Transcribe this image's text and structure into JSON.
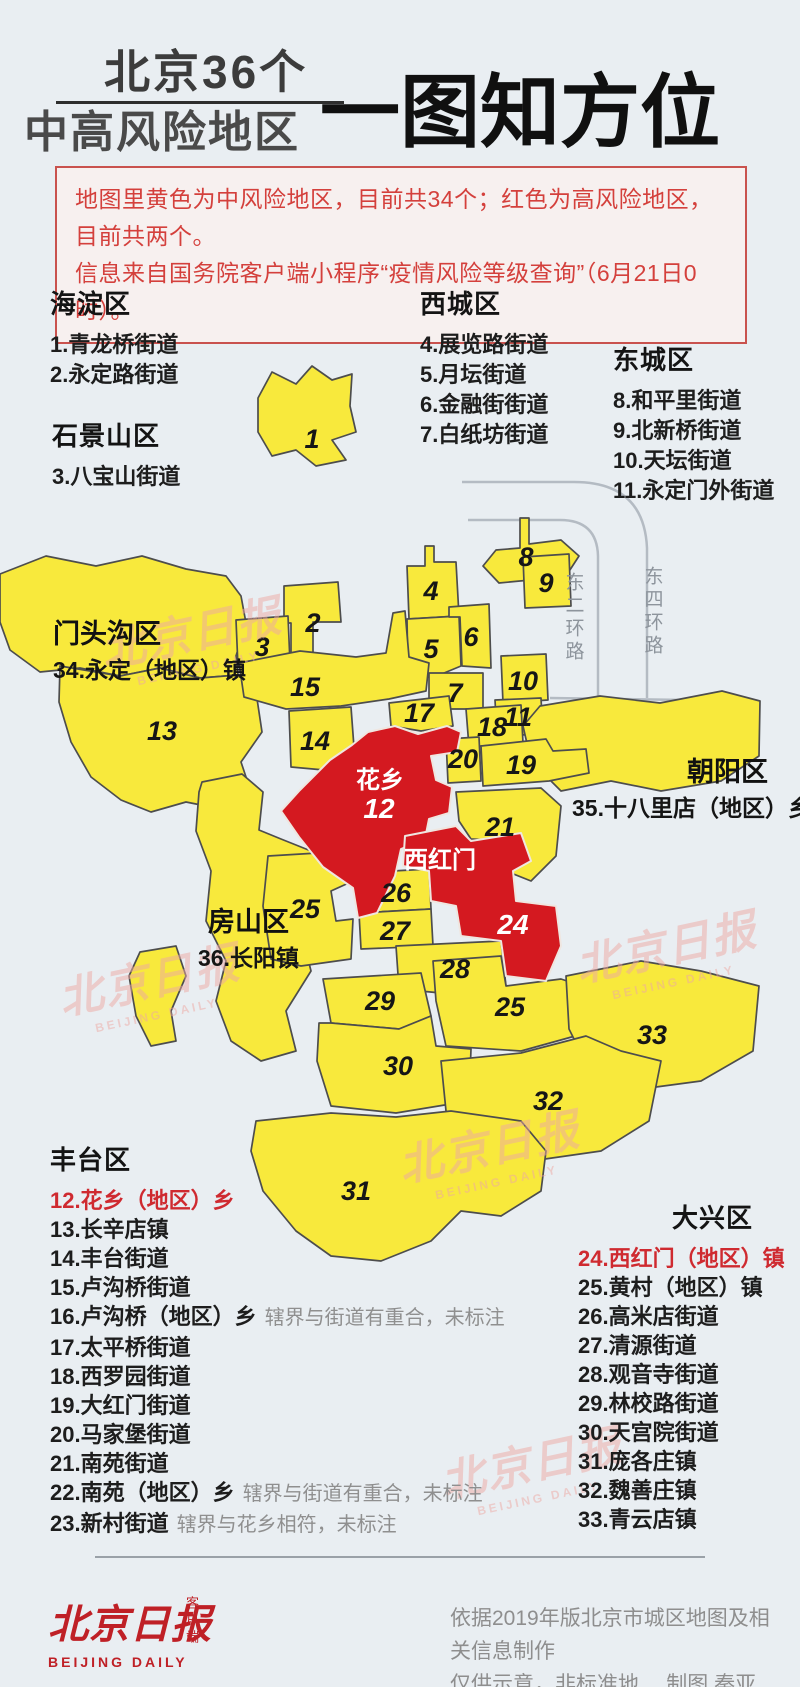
{
  "header": {
    "title_line1": "北京36个",
    "title_line2": "中高风险地区",
    "title_right": "一图知方位"
  },
  "notice": {
    "line1": "地图里黄色为中风险地区，目前共34个；红色为高风险地区，目前共两个。",
    "line2": "信息来自国务院客户端小程序“疫情风险等级查询”（6月21日0时）。"
  },
  "legend": {
    "haidian": {
      "title": "海淀区",
      "items": [
        {
          "text": "1.青龙桥街道"
        },
        {
          "text": "2.永定路街道"
        }
      ]
    },
    "shijingshan": {
      "title": "石景山区",
      "items": [
        {
          "text": "3.八宝山街道"
        }
      ]
    },
    "xicheng": {
      "title": "西城区",
      "items": [
        {
          "text": "4.展览路街道"
        },
        {
          "text": "5.月坛街道"
        },
        {
          "text": "6.金融街街道"
        },
        {
          "text": "7.白纸坊街道"
        }
      ]
    },
    "dongcheng": {
      "title": "东城区",
      "items": [
        {
          "text": "8.和平里街道"
        },
        {
          "text": "9.北新桥街道"
        },
        {
          "text": "10.天坛街道"
        },
        {
          "text": "11.永定门外街道"
        }
      ]
    },
    "fengtai": {
      "title": "丰台区",
      "items": [
        {
          "text": "12.花乡（地区）乡",
          "red": true
        },
        {
          "text": "13.长辛店镇"
        },
        {
          "text": "14.丰台街道"
        },
        {
          "text": "15.卢沟桥街道"
        },
        {
          "text": "16.卢沟桥（地区）乡",
          "note": "辖界与街道有重合，未标注"
        },
        {
          "text": "17.太平桥街道"
        },
        {
          "text": "18.西罗园街道"
        },
        {
          "text": "19.大红门街道"
        },
        {
          "text": "20.马家堡街道"
        },
        {
          "text": "21.南苑街道"
        },
        {
          "text": "22.南苑（地区）乡",
          "note": "辖界与街道有重合，未标注"
        },
        {
          "text": "23.新村街道",
          "note": "辖界与花乡相符，未标注"
        }
      ]
    },
    "daxing": {
      "title": "大兴区",
      "items": [
        {
          "text": "24.西红门（地区）镇",
          "red": true
        },
        {
          "text": "25.黄村（地区）镇"
        },
        {
          "text": "26.高米店街道"
        },
        {
          "text": "27.清源街道"
        },
        {
          "text": "28.观音寺街道"
        },
        {
          "text": "29.林校路街道"
        },
        {
          "text": "30.天宫院街道"
        },
        {
          "text": "31.庞各庄镇"
        },
        {
          "text": "32.魏善庄镇"
        },
        {
          "text": "33.青云店镇"
        }
      ]
    }
  },
  "map": {
    "colors": {
      "medium_risk": "#f8e93c",
      "high_risk": "#d41920"
    },
    "district_overlays": {
      "mentougou": {
        "title": "门头沟区",
        "item": "34.永定（地区）镇"
      },
      "fangshan": {
        "title": "房山区",
        "item": "36.长阳镇"
      },
      "chaoyang": {
        "title": "朝阳区",
        "item": "35.十八里店（地区）乡"
      }
    },
    "roads": [
      "东二环路",
      "东四环路"
    ],
    "red_labels": {
      "huaxiang_name": "花乡",
      "huaxiang_num": "12",
      "xihongmen_name": "西红门",
      "xihongmen_num": "24"
    },
    "numbers": [
      "1",
      "2",
      "3",
      "4",
      "5",
      "6",
      "7",
      "8",
      "9",
      "10",
      "11",
      "13",
      "14",
      "15",
      "17",
      "18",
      "19",
      "20",
      "21",
      "25",
      "26",
      "27",
      "28",
      "29",
      "25",
      "30",
      "31",
      "32",
      "33"
    ]
  },
  "watermark": {
    "text": "北京日报",
    "sub": "BEIJING DAILY"
  },
  "footer": {
    "logo_text": "北京日报",
    "logo_side": "客户端",
    "logo_sub": "BEIJING DAILY",
    "credit_line1": "依据2019年版北京市城区地图及相关信息制作",
    "credit_line2": "仅供示意，非标准地图。",
    "credit_author": "制图 秦亚堙"
  }
}
